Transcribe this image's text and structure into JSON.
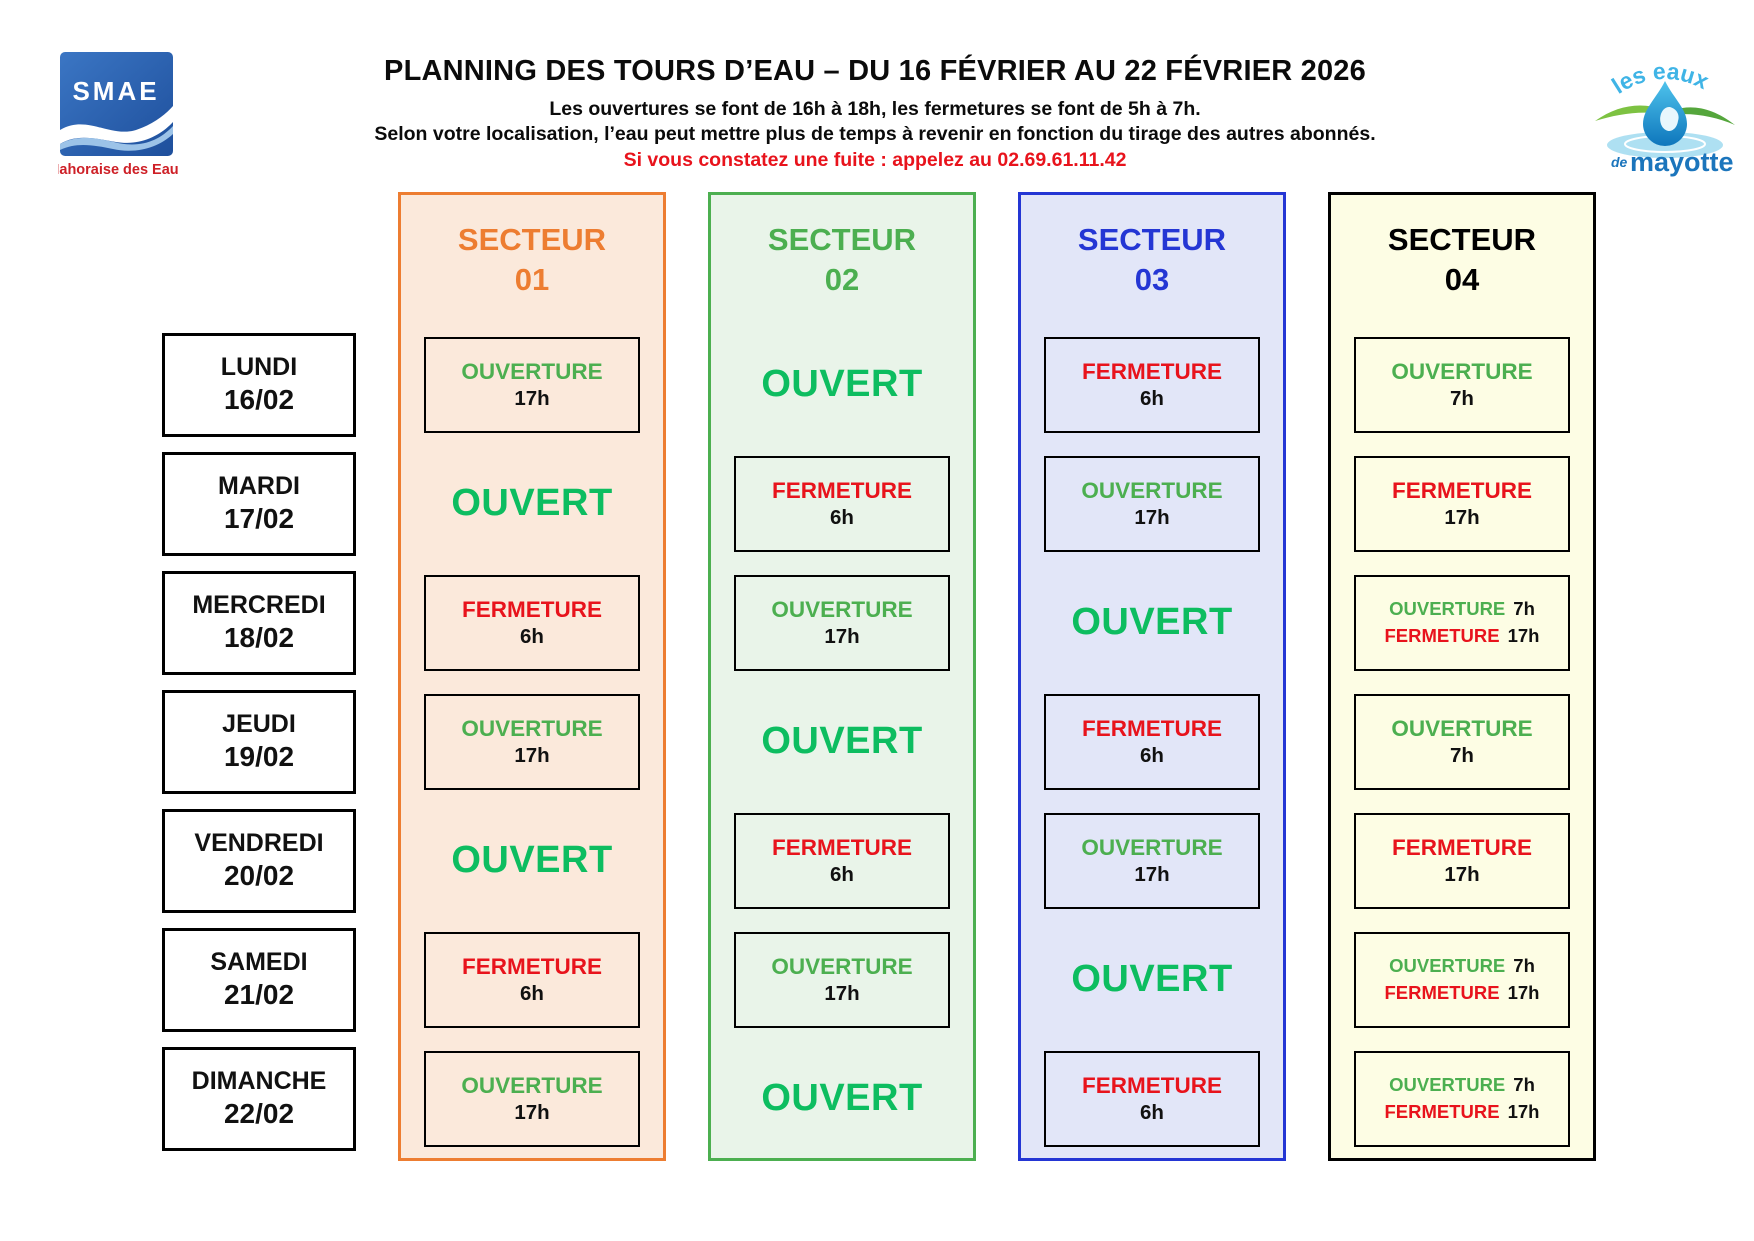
{
  "header": {
    "title": "PLANNING DES TOURS D’EAU – DU 16 FÉVRIER AU 22 FÉVRIER 2026",
    "subtitle_hours": "Les ouvertures se font de 16h à 18h, les fermetures se font de 5h à 7h.",
    "subtitle_note": "Selon votre localisation, l’eau peut mettre plus de temps à revenir en fonction du tirage des autres abonnés.",
    "leak_alert": "Si vous constatez une fuite : appelez au 02.69.61.11.42",
    "alert_color": "#e8131c"
  },
  "logos": {
    "smae": {
      "name": "SMAE",
      "tagline": "Mahoraise des Eaux",
      "square_color": "#2a5caa",
      "tagline_color": "#ce2027"
    },
    "mayotte": {
      "arc_text": "les eaux",
      "sub_prefix": "de",
      "sub_text": "mayotte",
      "arc_color": "#3fb4e6",
      "sub_color": "#1b75bc",
      "drop_color": "#29abe2",
      "leaf_color": "#7dc242",
      "ripple_color": "#aee0f2"
    }
  },
  "status_colors": {
    "open": "#4caf50",
    "close": "#e8131c",
    "time": "#111111",
    "ouvert": "#0dbd60"
  },
  "days": [
    {
      "label": "LUNDI",
      "date": "16/02"
    },
    {
      "label": "MARDI",
      "date": "17/02"
    },
    {
      "label": "MERCREDI",
      "date": "18/02"
    },
    {
      "label": "JEUDI",
      "date": "19/02"
    },
    {
      "label": "VENDREDI",
      "date": "20/02"
    },
    {
      "label": "SAMEDI",
      "date": "21/02"
    },
    {
      "label": "DIMANCHE",
      "date": "22/02"
    }
  ],
  "sectors": [
    {
      "title": "SECTEUR",
      "number": "01",
      "accent": "#ed7d31",
      "bg": "#fbe9db",
      "cells": [
        {
          "boxed": true,
          "size": "normal",
          "rows": [
            [
              {
                "text": "OUVERTURE",
                "color": "open"
              }
            ],
            [
              {
                "text": "17h",
                "color": "time"
              }
            ]
          ]
        },
        {
          "boxed": false,
          "size": "large",
          "rows": [
            [
              {
                "text": "OUVERT",
                "color": "ouvert"
              }
            ]
          ]
        },
        {
          "boxed": true,
          "size": "normal",
          "rows": [
            [
              {
                "text": "FERMETURE",
                "color": "close"
              }
            ],
            [
              {
                "text": "6h",
                "color": "time"
              }
            ]
          ]
        },
        {
          "boxed": true,
          "size": "normal",
          "rows": [
            [
              {
                "text": "OUVERTURE",
                "color": "open"
              }
            ],
            [
              {
                "text": "17h",
                "color": "time"
              }
            ]
          ]
        },
        {
          "boxed": false,
          "size": "large",
          "rows": [
            [
              {
                "text": "OUVERT",
                "color": "ouvert"
              }
            ]
          ]
        },
        {
          "boxed": true,
          "size": "normal",
          "rows": [
            [
              {
                "text": "FERMETURE",
                "color": "close"
              }
            ],
            [
              {
                "text": "6h",
                "color": "time"
              }
            ]
          ]
        },
        {
          "boxed": true,
          "size": "normal",
          "rows": [
            [
              {
                "text": "OUVERTURE",
                "color": "open"
              }
            ],
            [
              {
                "text": "17h",
                "color": "time"
              }
            ]
          ]
        }
      ]
    },
    {
      "title": "SECTEUR",
      "number": "02",
      "accent": "#4caf50",
      "bg": "#e9f4e9",
      "cells": [
        {
          "boxed": false,
          "size": "large",
          "rows": [
            [
              {
                "text": "OUVERT",
                "color": "ouvert"
              }
            ]
          ]
        },
        {
          "boxed": true,
          "size": "normal",
          "rows": [
            [
              {
                "text": "FERMETURE",
                "color": "close"
              }
            ],
            [
              {
                "text": "6h",
                "color": "time"
              }
            ]
          ]
        },
        {
          "boxed": true,
          "size": "normal",
          "rows": [
            [
              {
                "text": "OUVERTURE",
                "color": "open"
              }
            ],
            [
              {
                "text": "17h",
                "color": "time"
              }
            ]
          ]
        },
        {
          "boxed": false,
          "size": "large",
          "rows": [
            [
              {
                "text": "OUVERT",
                "color": "ouvert"
              }
            ]
          ]
        },
        {
          "boxed": true,
          "size": "normal",
          "rows": [
            [
              {
                "text": "FERMETURE",
                "color": "close"
              }
            ],
            [
              {
                "text": "6h",
                "color": "time"
              }
            ]
          ]
        },
        {
          "boxed": true,
          "size": "normal",
          "rows": [
            [
              {
                "text": "OUVERTURE",
                "color": "open"
              }
            ],
            [
              {
                "text": "17h",
                "color": "time"
              }
            ]
          ]
        },
        {
          "boxed": false,
          "size": "large",
          "rows": [
            [
              {
                "text": "OUVERT",
                "color": "ouvert"
              }
            ]
          ]
        }
      ]
    },
    {
      "title": "SECTEUR",
      "number": "03",
      "accent": "#2436d4",
      "bg": "#e2e6f8",
      "cells": [
        {
          "boxed": true,
          "size": "normal",
          "rows": [
            [
              {
                "text": "FERMETURE",
                "color": "close"
              }
            ],
            [
              {
                "text": "6h",
                "color": "time"
              }
            ]
          ]
        },
        {
          "boxed": true,
          "size": "normal",
          "rows": [
            [
              {
                "text": "OUVERTURE",
                "color": "open"
              }
            ],
            [
              {
                "text": "17h",
                "color": "time"
              }
            ]
          ]
        },
        {
          "boxed": false,
          "size": "large",
          "rows": [
            [
              {
                "text": "OUVERT",
                "color": "ouvert"
              }
            ]
          ]
        },
        {
          "boxed": true,
          "size": "normal",
          "rows": [
            [
              {
                "text": "FERMETURE",
                "color": "close"
              }
            ],
            [
              {
                "text": "6h",
                "color": "time"
              }
            ]
          ]
        },
        {
          "boxed": true,
          "size": "normal",
          "rows": [
            [
              {
                "text": "OUVERTURE",
                "color": "open"
              }
            ],
            [
              {
                "text": "17h",
                "color": "time"
              }
            ]
          ]
        },
        {
          "boxed": false,
          "size": "large",
          "rows": [
            [
              {
                "text": "OUVERT",
                "color": "ouvert"
              }
            ]
          ]
        },
        {
          "boxed": true,
          "size": "normal",
          "rows": [
            [
              {
                "text": "FERMETURE",
                "color": "close"
              }
            ],
            [
              {
                "text": "6h",
                "color": "time"
              }
            ]
          ]
        }
      ]
    },
    {
      "title": "SECTEUR",
      "number": "04",
      "accent": "#000000",
      "bg": "#fdfde4",
      "cells": [
        {
          "boxed": true,
          "size": "normal",
          "rows": [
            [
              {
                "text": "OUVERTURE",
                "color": "open"
              }
            ],
            [
              {
                "text": "7h",
                "color": "time"
              }
            ]
          ]
        },
        {
          "boxed": true,
          "size": "normal",
          "rows": [
            [
              {
                "text": "FERMETURE",
                "color": "close"
              }
            ],
            [
              {
                "text": "17h",
                "color": "time"
              }
            ]
          ]
        },
        {
          "boxed": true,
          "size": "small",
          "rows": [
            [
              {
                "text": "OUVERTURE",
                "color": "open"
              },
              {
                "text": "7h",
                "color": "time"
              }
            ],
            [
              {
                "text": "FERMETURE",
                "color": "close"
              },
              {
                "text": "17h",
                "color": "time"
              }
            ]
          ]
        },
        {
          "boxed": true,
          "size": "normal",
          "rows": [
            [
              {
                "text": "OUVERTURE",
                "color": "open"
              }
            ],
            [
              {
                "text": "7h",
                "color": "time"
              }
            ]
          ]
        },
        {
          "boxed": true,
          "size": "normal",
          "rows": [
            [
              {
                "text": "FERMETURE",
                "color": "close"
              }
            ],
            [
              {
                "text": "17h",
                "color": "time"
              }
            ]
          ]
        },
        {
          "boxed": true,
          "size": "small",
          "rows": [
            [
              {
                "text": "OUVERTURE",
                "color": "open"
              },
              {
                "text": "7h",
                "color": "time"
              }
            ],
            [
              {
                "text": "FERMETURE",
                "color": "close"
              },
              {
                "text": "17h",
                "color": "time"
              }
            ]
          ]
        },
        {
          "boxed": true,
          "size": "small",
          "rows": [
            [
              {
                "text": "OUVERTURE",
                "color": "open"
              },
              {
                "text": "7h",
                "color": "time"
              }
            ],
            [
              {
                "text": "FERMETURE",
                "color": "close"
              },
              {
                "text": "17h",
                "color": "time"
              }
            ]
          ]
        }
      ]
    }
  ]
}
